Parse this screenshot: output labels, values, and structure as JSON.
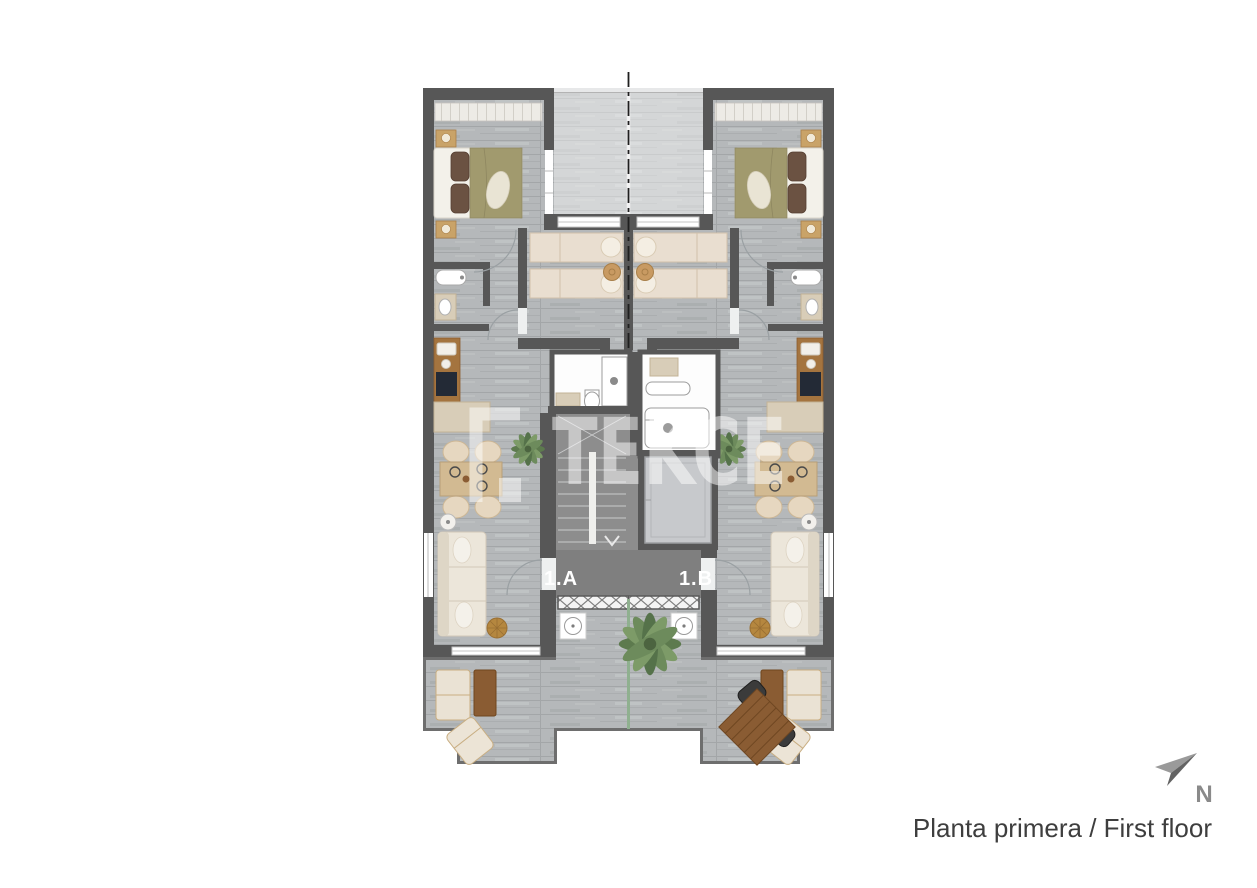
{
  "page": {
    "background": "#ffffff"
  },
  "plan": {
    "caption": "Planta primera / First floor",
    "compass_label": "N",
    "watermark_text": "TEKCE",
    "unit_labels": [
      "1.A",
      "1.B"
    ]
  },
  "colors": {
    "wall": "#575757",
    "floor_wood": "#b5b8ba",
    "terrace_wood": "#d3d4d6",
    "landing": "#7f7f7f",
    "stair_hall": "#8d8d8d",
    "bed_cover_olive": "#a19a6e",
    "pillow_brown": "#6b5242",
    "kitchen_wood": "#a4743f",
    "outdoor_wood": "#8a5c33",
    "upholstery_cream": "#ece6da",
    "plant_green": "#6d8b5c",
    "divider_green": "#8fb08f",
    "caption_text": "#3e3e3e",
    "compass_gray": "#8a8a8a",
    "unit_label_text": "#ffffff",
    "watermark_white": "#ffffff"
  }
}
